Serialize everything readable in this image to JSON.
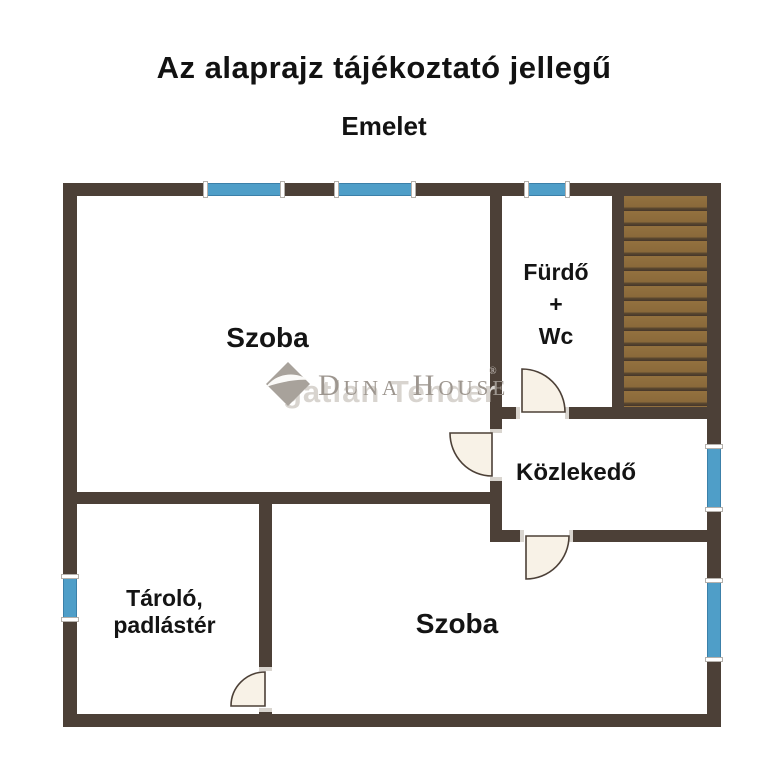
{
  "header": {
    "title": "Az alaprajz tájékoztató jellegű",
    "subtitle": "Emelet"
  },
  "floor_plan": {
    "rooms": {
      "szoba_top": {
        "label": "Szoba"
      },
      "furdo_wc": {
        "line1": "Fürdő",
        "line2": "+",
        "line3": "Wc"
      },
      "kozlekedo": {
        "label": "Közlekedő"
      },
      "tarolo": {
        "label": "Tároló, padlástér"
      },
      "szoba_bottom": {
        "label": "Szoba"
      }
    },
    "colors": {
      "wall": "#4c4037",
      "window": "#4f9ec8",
      "stair_tread": "#8a693a",
      "stair_gap": "#45362a",
      "door_fill": "#f8f2e7"
    }
  },
  "watermark": {
    "brand": "Duna House",
    "registered_mark": "®",
    "background_text": "gatlan Tender",
    "logo_icon": "diamond-swoosh-icon"
  }
}
